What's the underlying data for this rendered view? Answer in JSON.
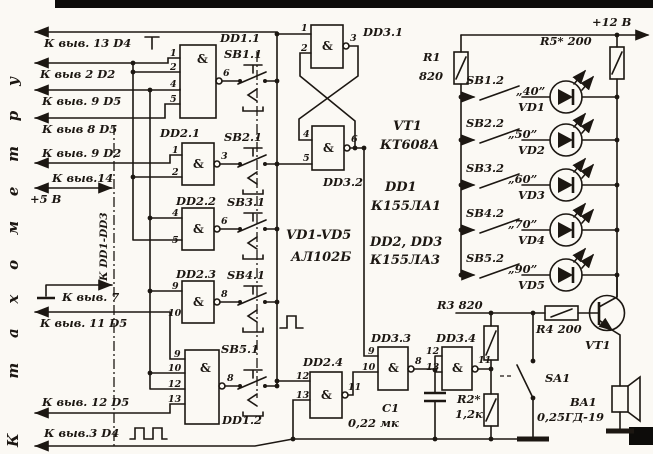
{
  "colors": {
    "paper": "#fbf9f4",
    "ink": "#1c1712"
  },
  "side_note": "К тахометру",
  "bus_note": "К DD1-DD3",
  "gate_symbol": "&",
  "left_inputs": [
    {
      "label": "К выв. 13 D4"
    },
    {
      "label": "К выв 2 D2"
    },
    {
      "label": "К выв. 9 D5"
    },
    {
      "label": "К выв 8 D5"
    },
    {
      "label": "К выв. 9 D2"
    },
    {
      "label": "К выв.14"
    },
    {
      "label": "+5 В"
    },
    {
      "label": "К выв. 7"
    },
    {
      "label": "К выв. 11 D5"
    },
    {
      "label": "К выв. 12 D5"
    },
    {
      "label": "К выв.3 D4"
    }
  ],
  "gates": [
    {
      "ref": "DD1.1",
      "pins_in": [
        "1",
        "2",
        "4",
        "5"
      ],
      "pin_out": "6"
    },
    {
      "ref": "DD2.1",
      "pins_in": [
        "1",
        "2"
      ],
      "pin_out": "3"
    },
    {
      "ref": "DD2.2",
      "pins_in": [
        "4",
        "5"
      ],
      "pin_out": "6"
    },
    {
      "ref": "DD2.3",
      "pins_in": [
        "9",
        "10"
      ],
      "pin_out": "8"
    },
    {
      "ref": "DD1.2",
      "pins_in": [
        "9",
        "10",
        "12",
        "13"
      ],
      "pin_out": "8"
    },
    {
      "ref": "DD3.1",
      "pins_in": [
        "1",
        "2"
      ],
      "pin_out": "3"
    },
    {
      "ref": "DD3.2",
      "pins_in": [
        "4",
        "5"
      ],
      "pin_out": "6"
    },
    {
      "ref": "DD2.4",
      "pins_in": [
        "12",
        "13"
      ],
      "pin_out": "11"
    },
    {
      "ref": "DD3.3",
      "pins_in": [
        "9",
        "10"
      ],
      "pin_out": "8"
    },
    {
      "ref": "DD3.4",
      "pins_in": [
        "12",
        "13"
      ],
      "pin_out": "11"
    }
  ],
  "buttons_left": [
    "SB1.1",
    "SB2.1",
    "SB3.1",
    "SB4.1",
    "SB5.1"
  ],
  "led_rows": [
    {
      "button": "SB1.2",
      "speed": "„40”",
      "led": "VD1"
    },
    {
      "button": "SB2.2",
      "speed": "„50”",
      "led": "VD2"
    },
    {
      "button": "SB3.2",
      "speed": "„60”",
      "led": "VD3"
    },
    {
      "button": "SB4.2",
      "speed": "„70”",
      "led": "VD4"
    },
    {
      "button": "SB5.2",
      "speed": "„90”",
      "led": "VD5"
    }
  ],
  "power": {
    "v12": "+12 В"
  },
  "components": {
    "r1_ref": "R1",
    "r1_val": "820",
    "r5": "R5* 200",
    "r3": "R3 820",
    "r4": "R4 200",
    "r2_ref": "R2*",
    "r2_val": "1,2к",
    "c1_ref": "С1",
    "c1_val": "0,22 мк",
    "sa1": "SA1",
    "vt1": "VT1",
    "ba1_ref": "BA1",
    "ba1_val": "0,25ГД-19"
  },
  "parts_list": [
    {
      "ref": "VT1",
      "val": "КТ608А"
    },
    {
      "ref": "DD1",
      "val": "К155ЛА1"
    },
    {
      "ref": "DD2, DD3",
      "val": "К155ЛА3"
    },
    {
      "ref": "VD1-VD5",
      "val": "АЛ102Б"
    }
  ]
}
